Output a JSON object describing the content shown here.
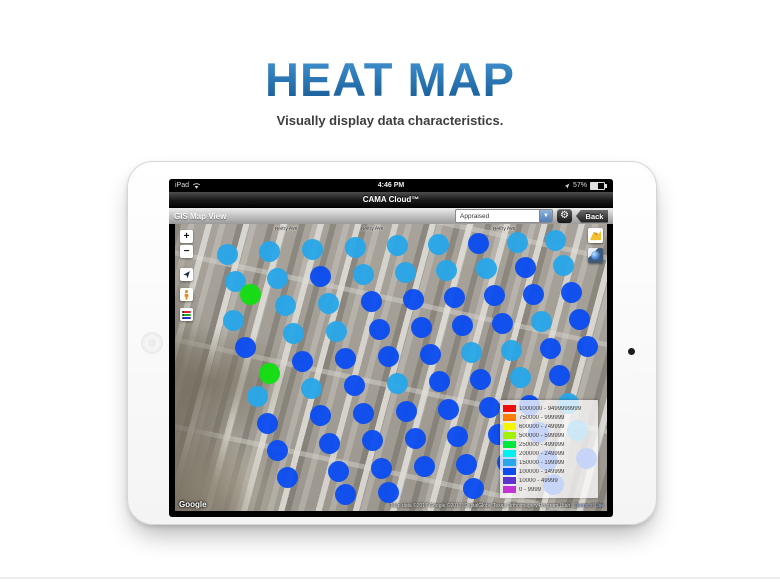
{
  "page": {
    "title": "HEAT MAP",
    "subtitle": "Visually display data characteristics."
  },
  "device": {
    "status_bar": {
      "carrier": "iPad",
      "time": "4:46 PM",
      "battery": "57%"
    },
    "title_bar": {
      "app_title": "CAMA Cloud™"
    },
    "toolbar": {
      "view_label": "GIS Map View",
      "dropdown_value": "Appraised",
      "dropdown_arrow": "▼",
      "gear_icon": "⚙",
      "back_label": "Back"
    }
  },
  "map": {
    "controls": {
      "zoom_in": "+",
      "zoom_out": "−"
    },
    "street_labels": [
      {
        "text": "Belfry Ave",
        "x": 100,
        "y": 2
      },
      {
        "text": "Belfry Ave",
        "x": 186,
        "y": 2
      },
      {
        "text": "Belfry Ave",
        "x": 318,
        "y": 2
      }
    ],
    "attribution": {
      "logo": "Google",
      "text": "Map data ©2017 Google   ©2017, DigitalGlobe   Texas Orthoimagery Program   Utah",
      "terms": "Terms of Use"
    },
    "legend": {
      "rows": [
        {
          "color": "#f20d0d",
          "label": "1000000 - 9499999999"
        },
        {
          "color": "#ff7d00",
          "label": "750000 - 999999"
        },
        {
          "color": "#f5f500",
          "label": "600000 - 749999"
        },
        {
          "color": "#a3f000",
          "label": "500000 - 599999"
        },
        {
          "color": "#00e83c",
          "label": "250000 - 499999"
        },
        {
          "color": "#00f0f0",
          "label": "200000 - 249999"
        },
        {
          "color": "#2aa7e8",
          "label": "150000 - 199999"
        },
        {
          "color": "#0b4df0",
          "label": "100000 - 149999"
        },
        {
          "color": "#5c33cc",
          "label": "10000 - 49999"
        },
        {
          "color": "#c233d6",
          "label": "0 - 9999"
        }
      ]
    },
    "dot_colors": [
      "#29a7e8",
      "#0b4df0",
      "#12df12"
    ],
    "dots": [
      [
        52,
        30,
        0
      ],
      [
        60,
        57,
        0
      ],
      [
        75,
        70,
        2
      ],
      [
        58,
        96,
        0
      ],
      [
        70,
        123,
        1
      ],
      [
        94,
        149,
        2
      ],
      [
        82,
        172,
        0
      ],
      [
        92,
        199,
        1
      ],
      [
        102,
        226,
        1
      ],
      [
        112,
        253,
        1
      ],
      [
        94,
        27,
        0
      ],
      [
        102,
        54,
        0
      ],
      [
        110,
        81,
        0
      ],
      [
        118,
        109,
        0
      ],
      [
        127,
        137,
        1
      ],
      [
        136,
        164,
        0
      ],
      [
        145,
        191,
        1
      ],
      [
        154,
        219,
        1
      ],
      [
        163,
        247,
        1
      ],
      [
        170,
        270,
        1
      ],
      [
        137,
        25,
        0
      ],
      [
        145,
        52,
        1
      ],
      [
        153,
        79,
        0
      ],
      [
        161,
        107,
        0
      ],
      [
        170,
        134,
        1
      ],
      [
        179,
        161,
        1
      ],
      [
        188,
        189,
        1
      ],
      [
        197,
        216,
        1
      ],
      [
        206,
        244,
        1
      ],
      [
        213,
        268,
        1
      ],
      [
        180,
        23,
        0
      ],
      [
        188,
        50,
        0
      ],
      [
        196,
        77,
        1
      ],
      [
        204,
        105,
        1
      ],
      [
        213,
        132,
        1
      ],
      [
        222,
        159,
        0
      ],
      [
        231,
        187,
        1
      ],
      [
        240,
        214,
        1
      ],
      [
        249,
        242,
        1
      ],
      [
        222,
        21,
        0
      ],
      [
        230,
        48,
        0
      ],
      [
        238,
        75,
        1
      ],
      [
        246,
        103,
        1
      ],
      [
        255,
        130,
        1
      ],
      [
        264,
        157,
        1
      ],
      [
        273,
        185,
        1
      ],
      [
        282,
        212,
        1
      ],
      [
        291,
        240,
        1
      ],
      [
        298,
        264,
        1
      ],
      [
        263,
        20,
        0
      ],
      [
        271,
        46,
        0
      ],
      [
        279,
        73,
        1
      ],
      [
        287,
        101,
        1
      ],
      [
        296,
        128,
        0
      ],
      [
        305,
        155,
        1
      ],
      [
        314,
        183,
        1
      ],
      [
        323,
        210,
        1
      ],
      [
        332,
        238,
        1
      ],
      [
        303,
        19,
        1
      ],
      [
        311,
        44,
        0
      ],
      [
        319,
        71,
        1
      ],
      [
        327,
        99,
        1
      ],
      [
        336,
        126,
        0
      ],
      [
        345,
        153,
        0
      ],
      [
        354,
        181,
        1
      ],
      [
        363,
        208,
        1
      ],
      [
        372,
        236,
        1
      ],
      [
        378,
        260,
        1
      ],
      [
        342,
        18,
        0
      ],
      [
        350,
        43,
        1
      ],
      [
        358,
        70,
        1
      ],
      [
        366,
        97,
        0
      ],
      [
        375,
        124,
        1
      ],
      [
        384,
        151,
        1
      ],
      [
        393,
        179,
        0
      ],
      [
        402,
        206,
        0
      ],
      [
        411,
        234,
        1
      ],
      [
        380,
        16,
        0
      ],
      [
        388,
        41,
        0
      ],
      [
        396,
        68,
        1
      ],
      [
        404,
        95,
        1
      ],
      [
        412,
        122,
        1
      ]
    ]
  }
}
